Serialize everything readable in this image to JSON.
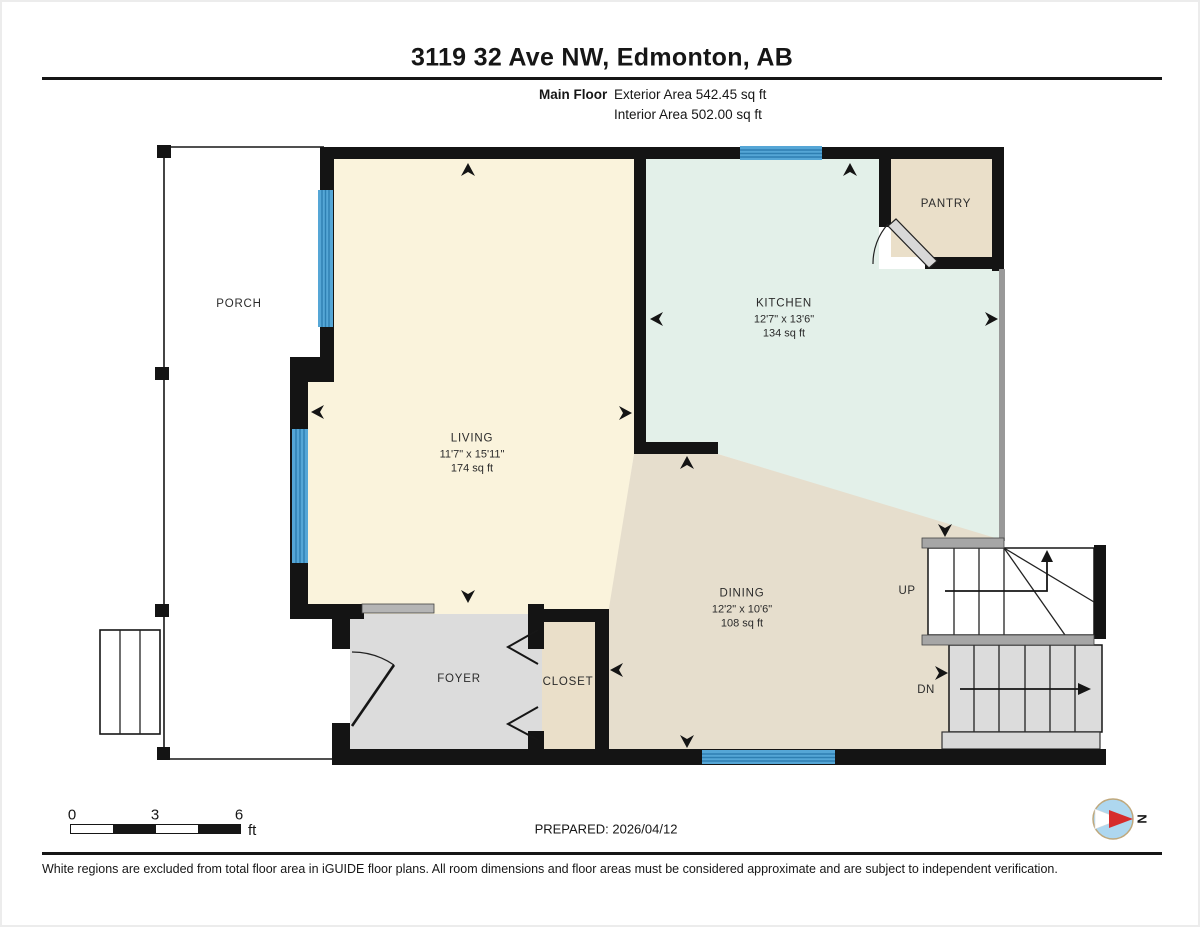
{
  "page": {
    "title": "3119 32 Ave NW, Edmonton, AB",
    "floor": {
      "label": "Main Floor",
      "exterior_area": "Exterior Area 542.45 sq ft",
      "interior_area": "Interior Area 502.00 sq ft"
    },
    "prepared": "PREPARED: 2026/04/12",
    "disclaimer": "White regions are excluded from total floor area in iGUIDE floor plans. All room dimensions and floor areas must be considered approximate and are subject to independent verification."
  },
  "rooms": {
    "porch": {
      "name": "PORCH"
    },
    "living": {
      "name": "LIVING",
      "dimensions": "11'7\" x 15'11\"",
      "area": "174 sq ft"
    },
    "kitchen": {
      "name": "KITCHEN",
      "dimensions": "12'7\" x 13'6\"",
      "area": "134 sq ft"
    },
    "dining": {
      "name": "DINING",
      "dimensions": "12'2\" x 10'6\"",
      "area": "108 sq ft"
    },
    "foyer": {
      "name": "FOYER"
    },
    "closet": {
      "name": "CLOSET"
    },
    "pantry": {
      "name": "PANTRY"
    }
  },
  "stairs": {
    "up_label": "UP",
    "down_label": "DN"
  },
  "scale_bar": {
    "ticks": [
      "0",
      "3",
      "6"
    ],
    "unit": "ft"
  },
  "compass": {
    "north_label": "N"
  },
  "colors": {
    "wall": "#141414",
    "window": "#55A6D6",
    "window_stripe": "#2E7FB2",
    "living": "#FAF3DC",
    "kitchen": "#E3F0E9",
    "dining": "#E6DECD",
    "pantry": "#EADFC9",
    "foyer": "#DCDCDC",
    "stair_gray": "#DCDCDC",
    "rail_gray": "#A6A6A6",
    "compass_red": "#D62B2B",
    "compass_blue": "#AED7EF"
  }
}
